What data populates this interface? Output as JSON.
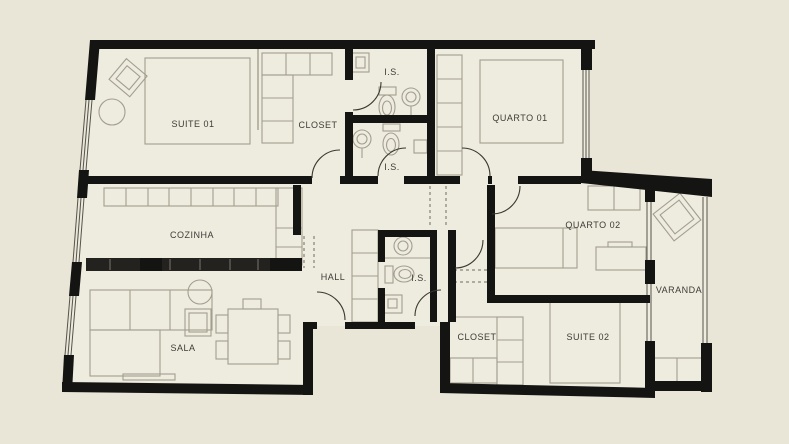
{
  "colors": {
    "background": "#e9e5d7",
    "floor": "#eeebdf",
    "wall": "#141412",
    "furniture_line": "#a29e8f",
    "label_text": "#3d3c36"
  },
  "labels": {
    "suite_01": "SUITE 01",
    "closet_top": "CLOSET",
    "is_top": "I.S.",
    "quarto_01": "QUARTO 01",
    "is_mid": "I.S.",
    "cozinha": "COZINHA",
    "hall": "HALL",
    "is_lower": "I.S.",
    "quarto_02": "QUARTO 02",
    "varanda": "VARANDA",
    "sala": "SALA",
    "closet_bottom": "CLOSET",
    "suite_02": "SUITE 02"
  }
}
